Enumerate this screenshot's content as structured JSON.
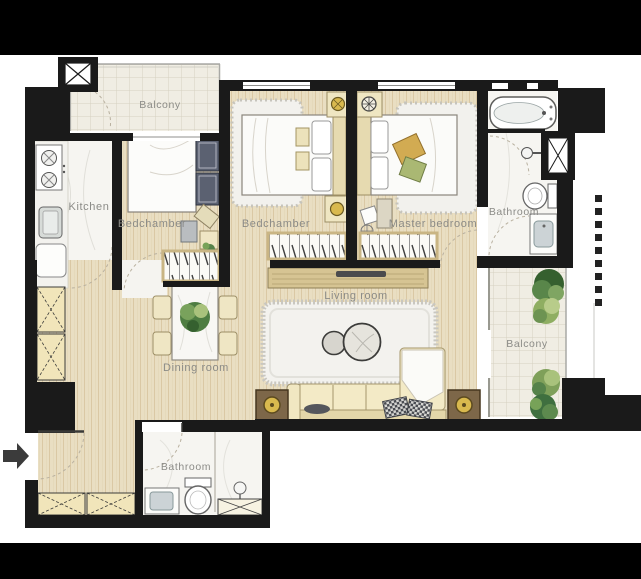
{
  "canvas": {
    "width": 641,
    "height": 579,
    "letterbox_color": "#000000",
    "background": "#ffffff"
  },
  "rooms": {
    "balcony_top": {
      "label": "Balcony"
    },
    "kitchen": {
      "label": "Kitchen"
    },
    "bedchamber_left": {
      "label": "Bedchamber"
    },
    "bedchamber_center": {
      "label": "Bedchamber"
    },
    "master_bedroom": {
      "label": "Master bedroom"
    },
    "bathroom_top": {
      "label": "Bathroom"
    },
    "living_room": {
      "label": "Living room"
    },
    "dining_room": {
      "label": "Dining room"
    },
    "balcony_right": {
      "label": "Balcony"
    },
    "bathroom_bottom": {
      "label": "Bathroom"
    }
  },
  "icons": {
    "entry_arrow": "right-arrow"
  },
  "colors": {
    "wall": "#1a1a1a",
    "wood_floor": "#e8ddc1",
    "tile_floor": "#efece3",
    "marble_floor": "#f6f5f1",
    "label_text": "#8b8b87",
    "cream_furniture": "#f1e7c2",
    "dark_wardrobe": "#5b6171",
    "plant_green": "#4e7d42",
    "accent_gold": "#d9b94e",
    "table_brown": "#7d6749"
  }
}
